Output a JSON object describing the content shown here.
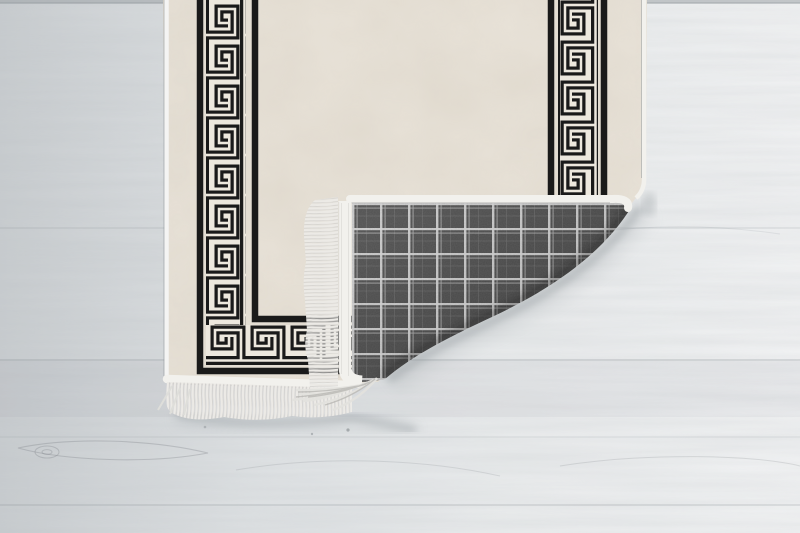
{
  "scene": {
    "description": "Product photo: beige runner rug with black Greek key meander border, bottom-right corner folded over showing grey tartan-check woven backing and white fringe, lying on a light whitewashed wooden plank floor",
    "setting_label": "Light whitewashed wooden plank floor with horizontal grain, plank seams and small knots",
    "subject_label": "Runner rug, corner folded back"
  },
  "rug": {
    "front_label": "Rug front: cream mottled field framed by a black Greek key (meander) band with thin black stripes on both sides, running down the left, right and bottom edges",
    "back_label": "Rug backing: dark grey woven tartan check with light grid lines",
    "fold_label": "Bottom-right corner folded up and over, sagging crease casting a soft shadow on the floor",
    "fringe_label": "White tasselled fringe along the bottom edge and along the folded corner edge",
    "edge_label": "White serged binding on all rug edges"
  },
  "floor": {
    "material_label": "wood planks",
    "grain_label": "horizontal grain streaks",
    "tone_label": "light grey, brighter toward the right"
  },
  "colors": {
    "floor-left": "#c8cccf",
    "floor-mid": "#dfe2e4",
    "floor-right": "#f1f2f3",
    "rug-cream": "#e8e2d8",
    "meander-bg": "#ede8de",
    "rug-black": "#1a1a1a",
    "plaid-base": "#4b4b4b",
    "plaid-line": "#d8d8d8",
    "fringe": "#eceae6",
    "binding": "#f2f1ed",
    "shadow": "#8d9499"
  }
}
